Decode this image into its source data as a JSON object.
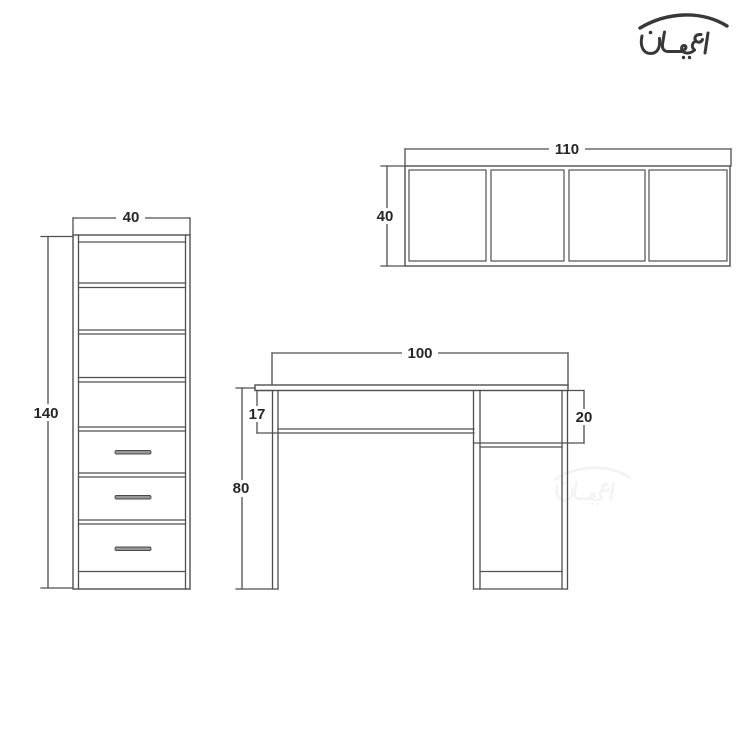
{
  "page": {
    "background_color": "#ffffff"
  },
  "logo": {
    "text": "اعيان",
    "color": "#383838"
  },
  "watermark": {
    "text": "اعيان",
    "opacity": "0.055"
  },
  "drawing": {
    "line_color": "#4f4f4f",
    "label_color": "#262626",
    "cabinet": {
      "width_label": "40",
      "height_label": "140"
    },
    "wall_shelf": {
      "width_label": "110",
      "height_label": "40"
    },
    "desk": {
      "width_label": "100",
      "height_label": "80",
      "apron_label": "17",
      "drawer_label": "20"
    }
  }
}
